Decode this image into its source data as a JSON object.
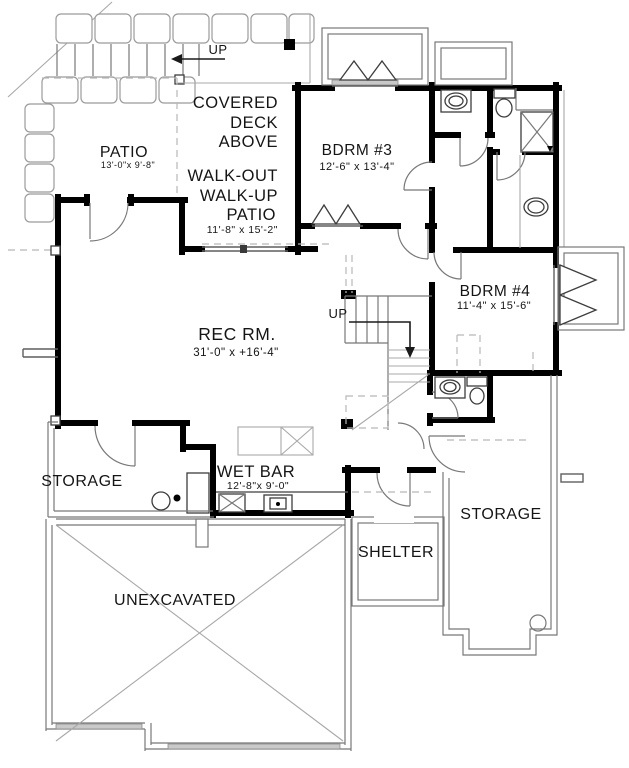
{
  "plan_title": "Basement Floor Plan",
  "rooms": {
    "covered_deck": {
      "lines": [
        "COVERED",
        "DECK",
        "ABOVE"
      ]
    },
    "patio": {
      "name": "PATIO",
      "dims": "13'-0\"x 9'-8\""
    },
    "walkup_patio": {
      "lines": [
        "WALK-OUT",
        "WALK-UP",
        "PATIO"
      ],
      "dims": "11'-8\" x 15'-2\""
    },
    "bdrm3": {
      "name": "BDRM #3",
      "dims": "12'-6\" x 13'-4\""
    },
    "bdrm4": {
      "name": "BDRM #4",
      "dims": "11'-4\" x 15'-6\""
    },
    "rec_room": {
      "name": "REC RM.",
      "dims": "31'-0\" x +16'-4\""
    },
    "wet_bar": {
      "name": "WET BAR",
      "dims": "12'-8\"x 9'-0\""
    },
    "storage_left": {
      "name": "STORAGE"
    },
    "storage_right": {
      "name": "STORAGE"
    },
    "shelter": {
      "name": "SHELTER"
    },
    "unexcavated": {
      "name": "UNEXCAVATED"
    }
  },
  "annotations": {
    "deck_stairs_up": "UP",
    "main_stairs_up": "UP"
  },
  "colors": {
    "wall": "#000000",
    "thin_line": "#5f5f5f",
    "stone_line": "#9b9b9b",
    "dashed_line": "#b8b8b8",
    "shading": "#c9c9c9",
    "text": "#151515",
    "paper": "#ffffff"
  }
}
